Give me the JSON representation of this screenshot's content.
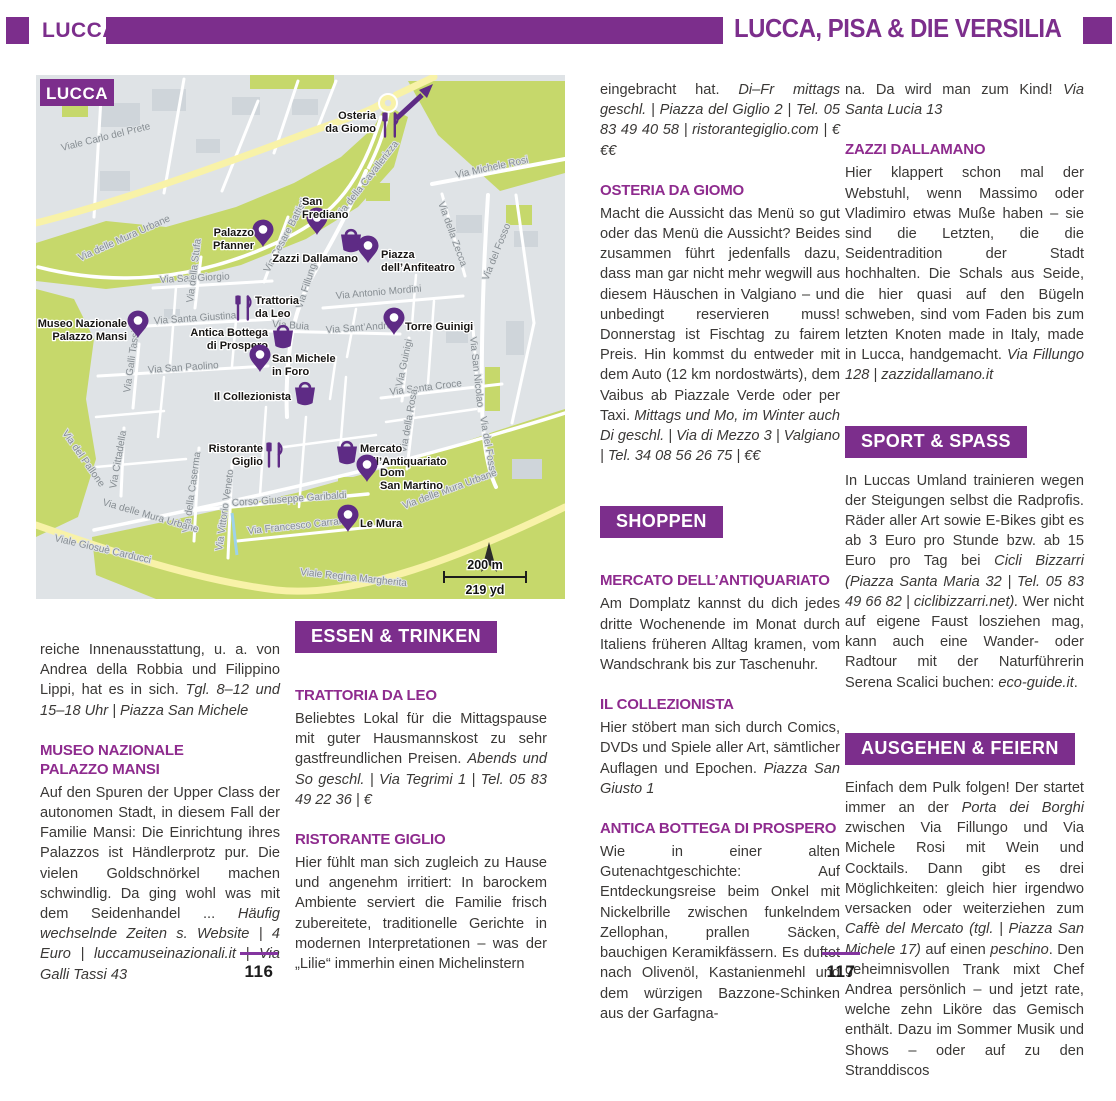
{
  "header": {
    "tab": "LUCCA",
    "title": "LUCCA, PISA & DIE VERSILIA"
  },
  "footer": {
    "left_number": "116",
    "right_number": "117"
  },
  "colors": {
    "purple": "#7c2e8c",
    "heading_purple": "#8e2b8e",
    "marker_purple": "#5e2b85",
    "map_background": "#dfe3e6",
    "map_green": "#c6d86b",
    "map_road_yellow": "#f8f2a8"
  },
  "map": {
    "title": "LUCCA",
    "scale": {
      "meters": "200 m",
      "yards": "219 yd"
    },
    "streets": [
      {
        "t": "Viale Carlo del Prete",
        "x": 26,
        "y": 76,
        "r": -14
      },
      {
        "t": "Via delle Mura Urbane",
        "x": 44,
        "y": 186,
        "r": -24
      },
      {
        "t": "Via San  Giorgio",
        "x": 124,
        "y": 208,
        "r": -3
      },
      {
        "t": "Via della Stufa",
        "x": 157,
        "y": 228,
        "r": -83
      },
      {
        "t": "Via Cesare Battisti",
        "x": 233,
        "y": 198,
        "r": -62
      },
      {
        "t": "Via Santa Giustina",
        "x": 118,
        "y": 249,
        "r": -4
      },
      {
        "t": "Via Buia",
        "x": 236,
        "y": 252,
        "r": 4
      },
      {
        "t": "Via Fillungo",
        "x": 266,
        "y": 234,
        "r": -72
      },
      {
        "t": "Via della Cavallerizza",
        "x": 304,
        "y": 144,
        "r": -52
      },
      {
        "t": "Via Michele Rosi",
        "x": 420,
        "y": 103,
        "r": -12
      },
      {
        "t": "Via della Zecca",
        "x": 402,
        "y": 128,
        "r": 70
      },
      {
        "t": "Via del Fosso",
        "x": 452,
        "y": 206,
        "r": -68
      },
      {
        "t": "Via Antonio Mordini",
        "x": 300,
        "y": 224,
        "r": -5
      },
      {
        "t": "Via Sant’Andrea",
        "x": 290,
        "y": 258,
        "r": -4
      },
      {
        "t": "Via Guinigi",
        "x": 366,
        "y": 312,
        "r": -78
      },
      {
        "t": "Via Santa Croce",
        "x": 354,
        "y": 320,
        "r": -7
      },
      {
        "t": "Via della Rosa",
        "x": 370,
        "y": 378,
        "r": -80
      },
      {
        "t": "Via San Nicolao",
        "x": 434,
        "y": 262,
        "r": 84
      },
      {
        "t": "Via del Fosso",
        "x": 444,
        "y": 342,
        "r": 80
      },
      {
        "t": "Via delle Mura Urbane",
        "x": 368,
        "y": 434,
        "r": -20
      },
      {
        "t": "Via Galli Tassi",
        "x": 94,
        "y": 318,
        "r": -82
      },
      {
        "t": "Via San Paolino",
        "x": 112,
        "y": 298,
        "r": -4
      },
      {
        "t": "Via del Pallone",
        "x": 26,
        "y": 358,
        "r": 55
      },
      {
        "t": "Via Cittadella",
        "x": 80,
        "y": 414,
        "r": -80
      },
      {
        "t": "Via della Caserma",
        "x": 153,
        "y": 458,
        "r": -82
      },
      {
        "t": "Via Vittorio Veneto",
        "x": 186,
        "y": 476,
        "r": -82
      },
      {
        "t": "Corso Giuseppe Garibaldi",
        "x": 196,
        "y": 431,
        "r": -4
      },
      {
        "t": "Via Francesco Carrara",
        "x": 212,
        "y": 459,
        "r": -6
      },
      {
        "t": "Viale Giosuè Carducci",
        "x": 18,
        "y": 466,
        "r": 13
      },
      {
        "t": "Via delle Mura Urbane",
        "x": 66,
        "y": 430,
        "r": 16
      },
      {
        "t": "Viale Regina Margherita",
        "x": 264,
        "y": 500,
        "r": 6
      }
    ],
    "pois": [
      {
        "label": [
          "Osteria",
          "da Giomo"
        ],
        "type": "restaurant",
        "x": 354,
        "y": 50,
        "anchor": "end",
        "lx": 340,
        "ly": 44
      },
      {
        "label": [
          "San",
          "Frediano"
        ],
        "type": "pin",
        "x": 281,
        "y": 160,
        "anchor": "start",
        "lx": 266,
        "ly": 130
      },
      {
        "label": [
          "Palazzo",
          "Pfanner"
        ],
        "type": "pin",
        "x": 227,
        "y": 172,
        "anchor": "end",
        "lx": 218,
        "ly": 161
      },
      {
        "label": [
          "Zazzi Dallamano"
        ],
        "type": "basket",
        "x": 315,
        "y": 168,
        "anchor": "end",
        "lx": 322,
        "ly": 187
      },
      {
        "label": [
          "Piazza",
          "dell’Anfiteatro"
        ],
        "type": "pin",
        "x": 332,
        "y": 188,
        "anchor": "start",
        "lx": 345,
        "ly": 183
      },
      {
        "label": [
          "Trattoria",
          "da Leo"
        ],
        "type": "restaurant",
        "x": 207,
        "y": 233,
        "anchor": "start",
        "lx": 219,
        "ly": 229
      },
      {
        "label": [
          "Torre Guinigi"
        ],
        "type": "pin",
        "x": 358,
        "y": 260,
        "anchor": "start",
        "lx": 369,
        "ly": 255
      },
      {
        "label": [
          "Museo Nazionale",
          "Palazzo Mansi"
        ],
        "type": "pin",
        "x": 102,
        "y": 263,
        "anchor": "end",
        "lx": 91,
        "ly": 252
      },
      {
        "label": [
          "Antica Bottega",
          "di Prospero"
        ],
        "type": "basket",
        "x": 247,
        "y": 264,
        "anchor": "end",
        "lx": 232,
        "ly": 261
      },
      {
        "label": [
          "San Michele",
          "in Foro"
        ],
        "type": "pin",
        "x": 224,
        "y": 297,
        "anchor": "start",
        "lx": 236,
        "ly": 287
      },
      {
        "label": [
          "Il Collezionista"
        ],
        "type": "basket",
        "x": 269,
        "y": 321,
        "anchor": "end",
        "lx": 255,
        "ly": 325
      },
      {
        "label": [
          "Ristorante",
          "Giglio"
        ],
        "type": "restaurant",
        "x": 238,
        "y": 380,
        "anchor": "end",
        "lx": 227,
        "ly": 377
      },
      {
        "label": [
          "Mercato",
          "dell’Antiquariato"
        ],
        "type": "basket",
        "x": 311,
        "y": 380,
        "anchor": "start",
        "lx": 324,
        "ly": 377
      },
      {
        "label": [
          "Dom",
          "San Martino"
        ],
        "type": "pin",
        "x": 331,
        "y": 407,
        "anchor": "start",
        "lx": 344,
        "ly": 401
      },
      {
        "label": [
          "Le Mura"
        ],
        "type": "pin",
        "x": 312,
        "y": 457,
        "anchor": "start",
        "lx": 324,
        "ly": 452
      }
    ]
  },
  "columns": [
    {
      "blocks": [
        {
          "type": "body",
          "segs": [
            {
              "t": "reiche Innenausstattung, u. a. von Andrea della Robbia und Filippino Lippi, hat es in sich. "
            },
            {
              "t": "Tgl. 8–12 und 15–18 Uhr | Piazza San Michele",
              "i": true
            }
          ]
        },
        {
          "type": "heading",
          "lines": [
            "MUSEO NAZIONALE",
            "PALAZZO MANSI"
          ]
        },
        {
          "type": "body",
          "segs": [
            {
              "t": "Auf den Spuren der Upper Class der autonomen Stadt, in diesem Fall der Familie Mansi: Die Einrichtung ihres Palazzos ist Händlerprotz pur. Die vielen Goldschnörkel machen schwindlig. Da ging wohl was mit dem Seidenhandel ... "
            },
            {
              "t": "Häufig wechselnde Zeiten s. Website | 4 Euro | luccamuseinazionali.it | Via Galli Tassi 43",
              "i": true
            }
          ]
        }
      ]
    },
    {
      "blocks": [
        {
          "type": "section",
          "t": "ESSEN & TRINKEN"
        },
        {
          "type": "heading",
          "lines": [
            "TRATTORIA DA LEO"
          ]
        },
        {
          "type": "body",
          "segs": [
            {
              "t": "Beliebtes Lokal für die Mittagspause mit guter Hausmannskost zu sehr gastfreundlichen Preisen. "
            },
            {
              "t": "Abends und So geschl. | Via Tegrimi 1 | Tel. 05 83 49 22 36 | €",
              "i": true
            }
          ]
        },
        {
          "type": "heading",
          "lines": [
            "RISTORANTE GIGLIO"
          ]
        },
        {
          "type": "body",
          "segs": [
            {
              "t": "Hier fühlt man sich zugleich zu Hause und angenehm irritiert: In barockem Ambiente serviert die Familie frisch zubereitete, traditionelle Gerichte in modernen Interpretationen – was der „Lilie“ immerhin einen Michelinstern"
            }
          ]
        }
      ]
    },
    {
      "blocks": [
        {
          "type": "body",
          "segs": [
            {
              "t": "eingebracht hat. "
            },
            {
              "t": "Di–Fr mittags geschl. | Piazza del Giglio 2 | Tel. 05 83 49 40 58 | ristorantegiglio.com | €€€",
              "i": true
            }
          ]
        },
        {
          "type": "heading",
          "lines": [
            "OSTERIA DA GIOMO"
          ]
        },
        {
          "type": "body",
          "segs": [
            {
              "t": "Macht die Aussicht das Menü so gut oder das Menü die Aussicht? Beides zusammen führt jedenfalls dazu, dass man gar nicht mehr wegwill aus diesem Häuschen in Valgiano – und unbedingt reservieren muss! Donnerstag ist Fischtag zu fairem Preis. Hin kommst du entweder mit dem Auto (12 km nordostwärts), dem Vaibus ab Piazzale Verde oder per Taxi. "
            },
            {
              "t": "Mittags und Mo, im Winter auch Di geschl. | Via di Mezzo 3 | Valgiano | Tel. 34 08 56 26 75 | €€",
              "i": true
            }
          ]
        },
        {
          "type": "section",
          "t": "SHOPPEN"
        },
        {
          "type": "heading",
          "lines": [
            "MERCATO DELL’ANTIQUARIATO"
          ]
        },
        {
          "type": "body",
          "segs": [
            {
              "t": "Am Domplatz kannst du dich jedes dritte Wochenende im Monat durch Italiens früheren Alltag kramen, vom Wandschrank bis zur Taschenuhr."
            }
          ]
        },
        {
          "type": "heading",
          "lines": [
            "IL COLLEZIONISTA"
          ]
        },
        {
          "type": "body",
          "segs": [
            {
              "t": "Hier stöbert man sich durch Comics, DVDs und Spiele aller Art, sämtlicher Auflagen und Epochen. "
            },
            {
              "t": "Piazza San Giusto 1",
              "i": true
            }
          ]
        },
        {
          "type": "heading",
          "lines": [
            "ANTICA BOTTEGA DI PROSPERO"
          ]
        },
        {
          "type": "body",
          "segs": [
            {
              "t": "Wie in einer alten Gutenachtgeschichte: Auf Entdeckungsreise beim Onkel mit Nickelbrille zwischen funkelndem Zellophan, prallen Säcken, bauchigen Keramikfässern. Es duftet nach Olivenöl, Kastanienmehl und dem würzigen Bazzone-Schinken aus der Garfagna-"
            }
          ]
        }
      ]
    },
    {
      "blocks": [
        {
          "type": "body",
          "segs": [
            {
              "t": "na. Da wird man zum Kind! "
            },
            {
              "t": "Via Santa Lucia 13",
              "i": true
            }
          ]
        },
        {
          "type": "heading",
          "lines": [
            "ZAZZI DALLAMANO"
          ]
        },
        {
          "type": "body",
          "segs": [
            {
              "t": "Hier klappert schon mal der Webstuhl, wenn Massimo oder Vladimiro etwas Muße haben – sie sind die Letzten, die die Seidentradition der Stadt hochhalten. Die Schals aus Seide, die hier quasi auf den Bügeln schweben, sind vom Faden bis zum letzten Knoten made in Italy, made in Lucca, handgemacht. "
            },
            {
              "t": "Via Fillungo 128 | zazzidallamano.it",
              "i": true
            }
          ]
        },
        {
          "type": "section",
          "t": "SPORT & SPASS"
        },
        {
          "type": "body",
          "segs": [
            {
              "t": "In Luccas Umland trainieren wegen der Steigungen selbst die Radprofis. Räder aller Art sowie E-Bikes gibt es ab 3 Euro pro Stunde bzw. ab 15 Euro pro Tag bei "
            },
            {
              "t": "Cicli Bizzarri (Piazza Santa Maria 32 | Tel. 05 83 49 66 82 | ciclibizzarri.net).",
              "i": true
            },
            {
              "t": " Wer nicht auf eigene Faust losziehen mag, kann auch eine Wander- oder Radtour mit der Naturführerin Serena Scalici buchen: "
            },
            {
              "t": "eco-guide.it",
              "i": true
            },
            {
              "t": "."
            }
          ]
        },
        {
          "type": "section",
          "t": "AUSGEHEN & FEIERN"
        },
        {
          "type": "body",
          "segs": [
            {
              "t": "Einfach dem Pulk folgen! Der startet immer an der "
            },
            {
              "t": "Porta dei Borghi",
              "i": true
            },
            {
              "t": " zwischen Via Fillungo und Via Michele Rosi mit Wein und Cocktails. Dann gibt es drei Möglichkeiten: gleich hier irgendwo versacken oder weiterziehen zum "
            },
            {
              "t": "Caffè del Mercato (tgl. | Piazza San Michele 17)",
              "i": true
            },
            {
              "t": " auf einen "
            },
            {
              "t": "peschino",
              "i": true
            },
            {
              "t": ". Den geheimnisvollen Trank mixt Chef Andrea persönlich – und jetzt rate, welche zehn Liköre das Gemisch enthält. Dazu im Sommer Musik und Shows – oder auf zu den Stranddiscos"
            }
          ]
        }
      ]
    }
  ]
}
